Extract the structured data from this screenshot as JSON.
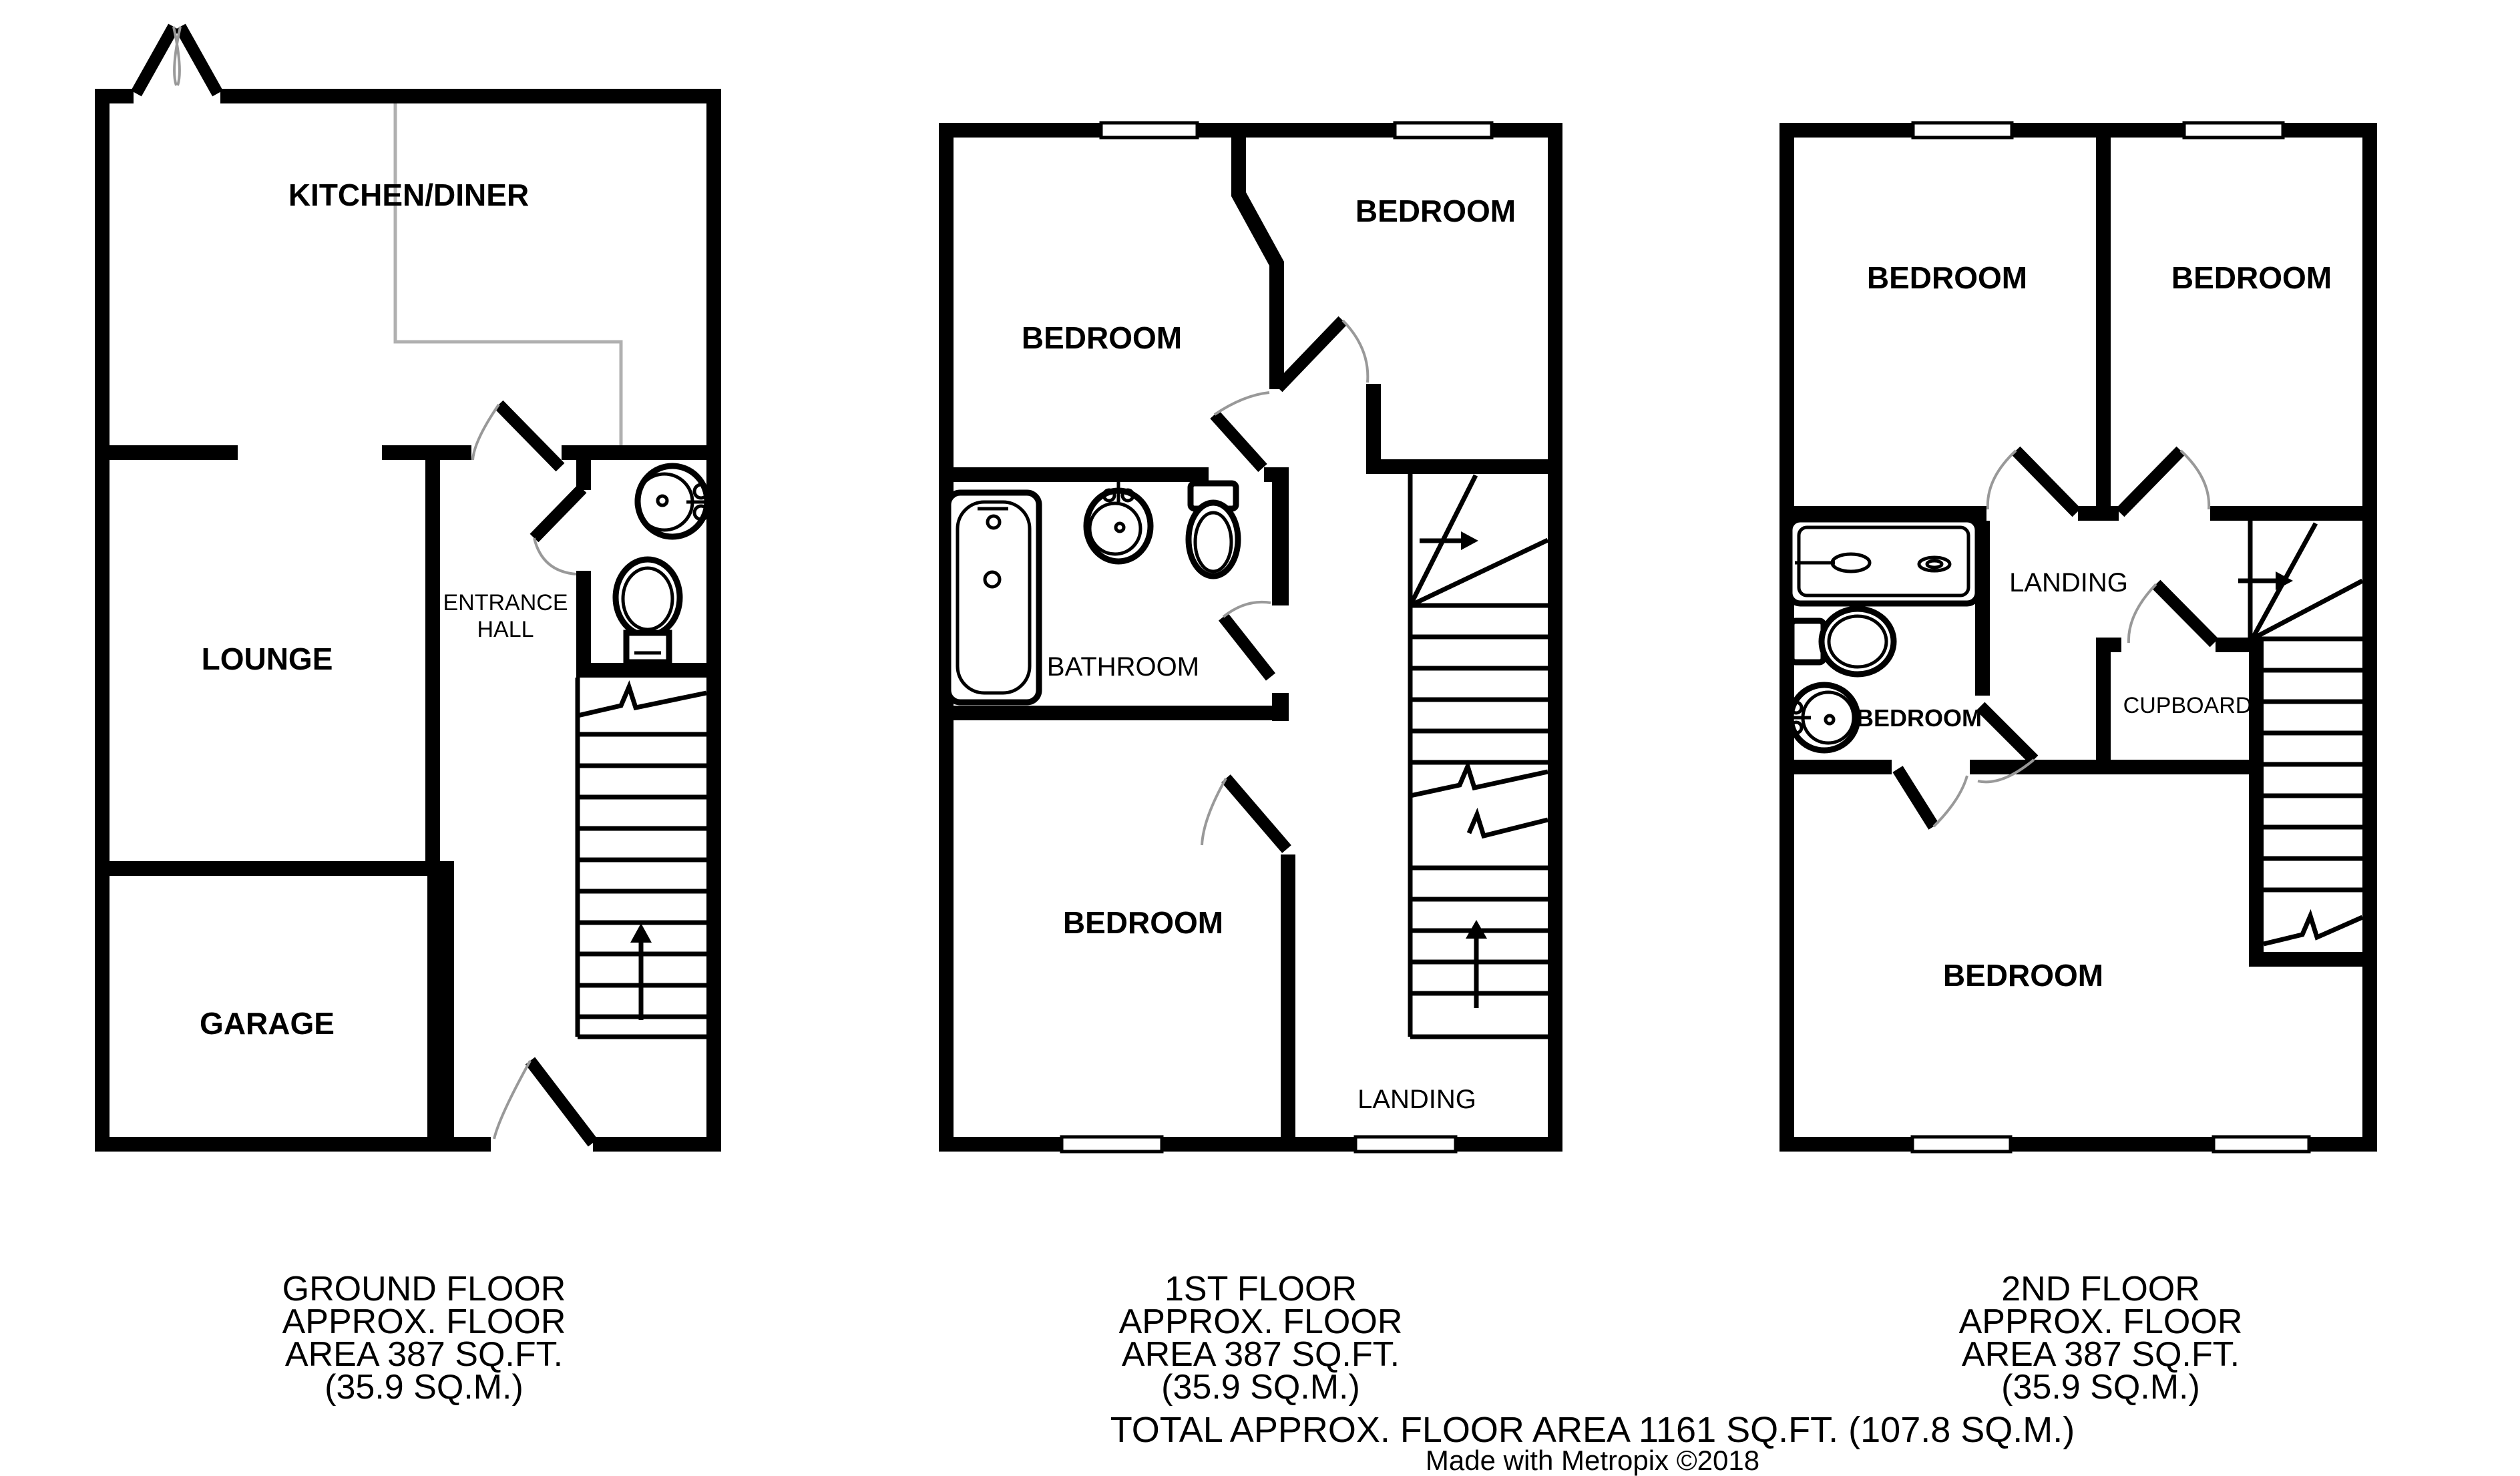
{
  "colors": {
    "wall": "#000000",
    "door_arc": "#999999",
    "counter_line": "#b0b0b0",
    "background": "#ffffff"
  },
  "floors": [
    {
      "name": "ground-floor",
      "rooms": {
        "kitchen_diner": "KITCHEN/DINER",
        "lounge": "LOUNGE",
        "entrance_hall_line1": "ENTRANCE",
        "entrance_hall_line2": "HALL",
        "garage": "GARAGE"
      },
      "footer": [
        "GROUND FLOOR",
        "APPROX. FLOOR",
        "AREA 387 SQ.FT.",
        "(35.9 SQ.M.)"
      ]
    },
    {
      "name": "first-floor",
      "rooms": {
        "bedroom_front": "BEDROOM",
        "bedroom_back": "BEDROOM",
        "bathroom": "BATHROOM",
        "bedroom_rear": "BEDROOM",
        "landing": "LANDING"
      },
      "footer": [
        "1ST FLOOR",
        "APPROX. FLOOR",
        "AREA 387 SQ.FT.",
        "(35.9 SQ.M.)"
      ]
    },
    {
      "name": "second-floor",
      "rooms": {
        "bedroom_left": "BEDROOM",
        "bedroom_right": "BEDROOM",
        "ensuite_bedroom": "BEDROOM",
        "landing": "LANDING",
        "cupboard": "CUPBOARD",
        "bedroom_main": "BEDROOM"
      },
      "footer": [
        "2ND FLOOR",
        "APPROX. FLOOR",
        "AREA 387 SQ.FT.",
        "(35.9 SQ.M.)"
      ]
    }
  ],
  "summary": {
    "total_area": "TOTAL APPROX. FLOOR AREA 1161 SQ.FT. (107.8 SQ.M.)",
    "credit": "Made with Metropix ©2018"
  }
}
